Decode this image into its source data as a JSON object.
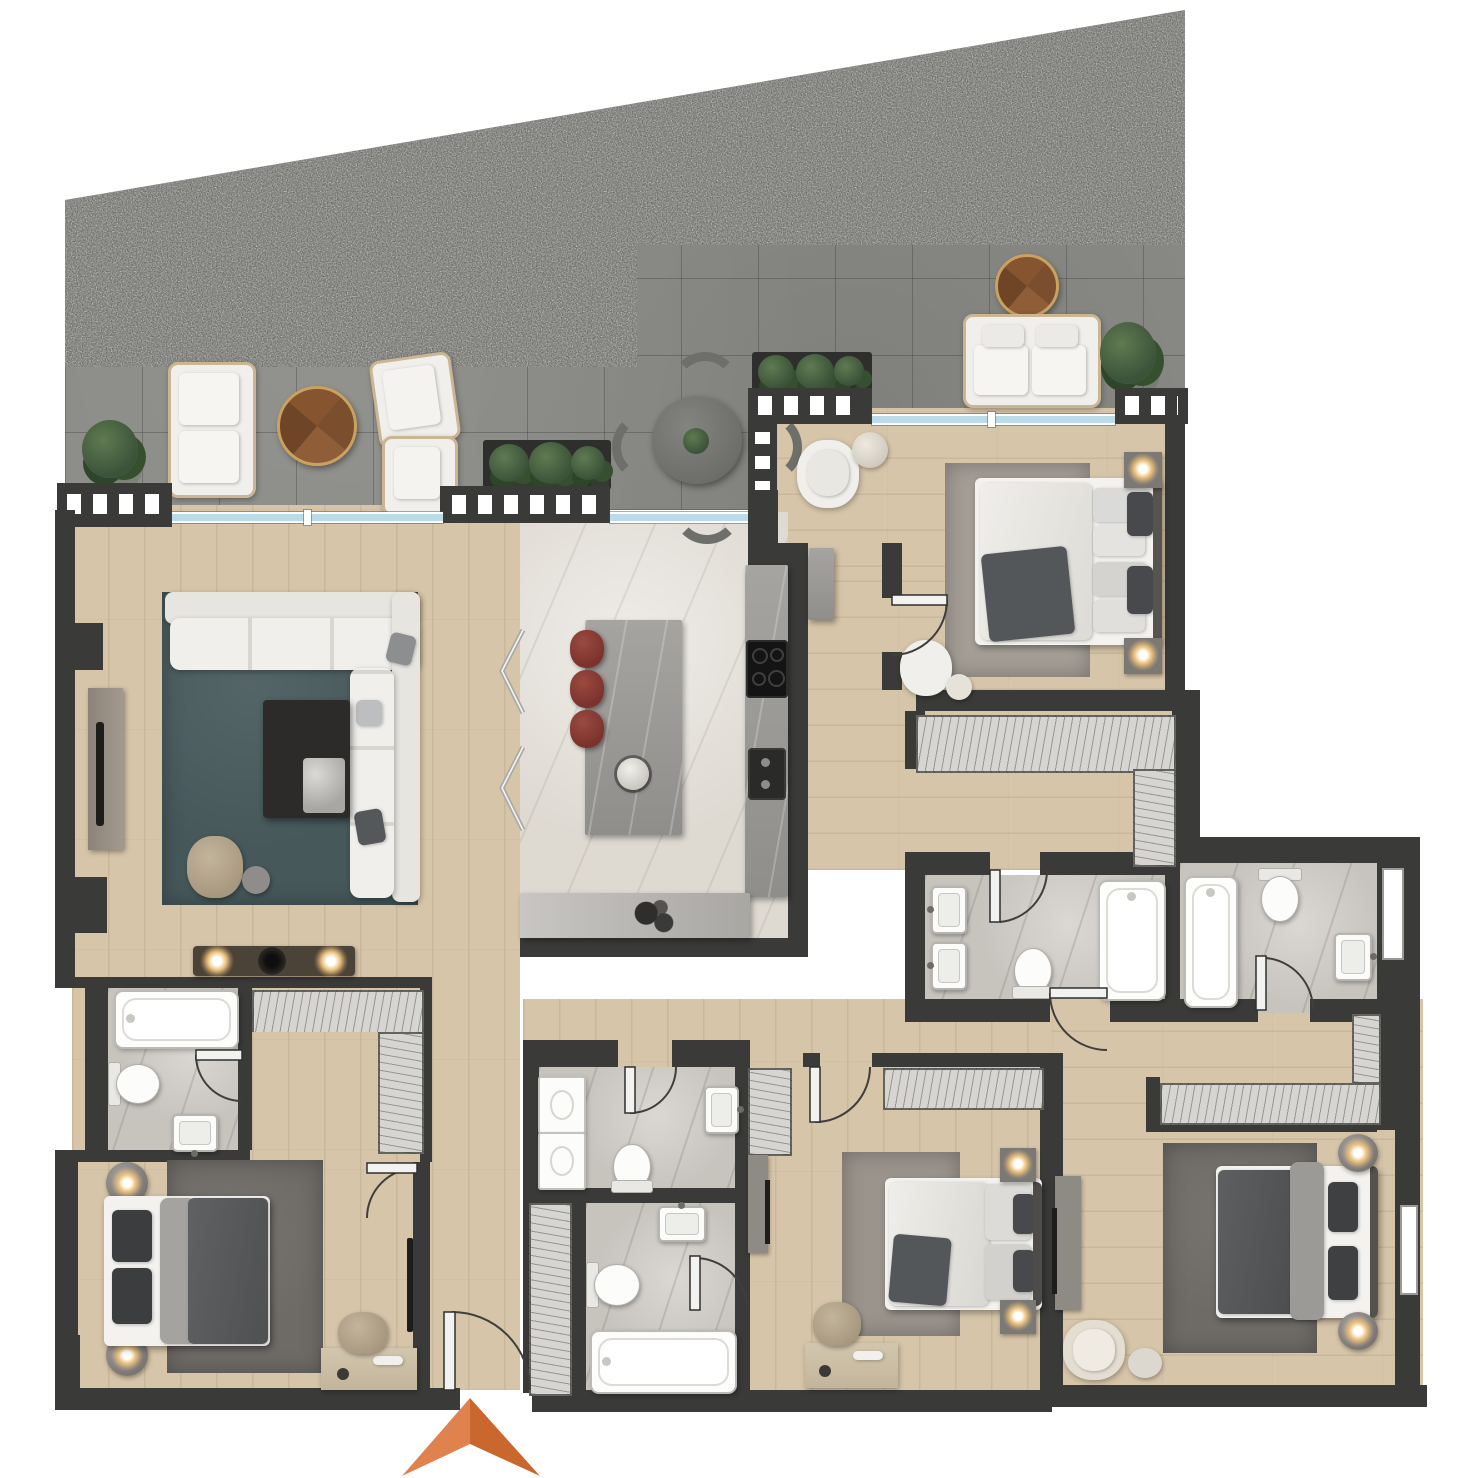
{
  "meta": {
    "scene": "apartment-floor-plan-render",
    "view": "top-down",
    "canvas": {
      "width": 1462,
      "height": 1478
    },
    "visible_text": "none"
  },
  "palette": {
    "white": "#ffffff",
    "wall": "#3a3a38",
    "wood": "#d6c5a9",
    "tile": "#8a8a86",
    "gravelBase": "#585855",
    "kitchenFloor": "#ded9d1",
    "bathFloor": "#c7c3bd",
    "closet": "#d7d5d1",
    "glass": "#badbe7",
    "sofa": "#f0efeb",
    "rugTeal": "#46585a",
    "rugGray": "#a49e96",
    "rugWarmGray": "#9a948c",
    "rugDark": "#6e6b67",
    "duvetDark": "#54575a",
    "mattress": "#f3f2ef",
    "stool": "#7c322c",
    "glow": "#ecc27c",
    "plant": "#3c5239",
    "arrowLight": "#e0824e",
    "arrowDark": "#c9672f",
    "consoleGray": "#8e8a84",
    "deskTan": "#ccbfa6"
  },
  "north_arrow": {
    "shape": "concave-triangle",
    "position": "bottom-center-at-entry",
    "colors": [
      "#e0824e",
      "#c9672f"
    ]
  },
  "terrace": {
    "name": "terrace",
    "surfaces": [
      "gravel-bed-sloped-top-edge",
      "stone-tile-deck"
    ],
    "boundary": [
      "parapet-with-white-balusters",
      "glazed-sliding-windows"
    ],
    "furniture": [
      "outdoor-loveseat",
      "round-wood-coffee-table",
      "lounge-chair",
      "lounge-chair",
      "planter-box",
      "planter-box",
      "outdoor-dining-table-4-chairs",
      "outdoor-sofa",
      "round-wood-side-table",
      "potted-plant",
      "potted-plant",
      "potted-plant"
    ]
  },
  "rooms": [
    {
      "id": "living-room",
      "floor": "wood",
      "furniture": [
        "l-shaped-sectional-sofa",
        "teal-area-rug",
        "dark-marble-coffee-table",
        "tan-lounge-chair",
        "round-side-table",
        "tv-console",
        "media-wall-with-three-ceiling-lights"
      ]
    },
    {
      "id": "kitchen",
      "floor": "light-marble",
      "furniture": [
        "marble-island",
        "red-bar-stool",
        "red-bar-stool",
        "red-bar-stool",
        "fruit-bowl",
        "tall-counter-with-cooktop-and-sink",
        "back-counter-with-appliances",
        "folding-glass-doors"
      ]
    },
    {
      "id": "hallway-entry",
      "floor": "wood",
      "furniture": [
        "entrance-door",
        "linen-closet",
        "console-cabinet"
      ]
    },
    {
      "id": "bedroom-top-right",
      "floor": "wood",
      "furniture": [
        "double-bed",
        "nightstand-lamp",
        "nightstand-lamp",
        "gray-rug",
        "lounge-chair",
        "round-side-table",
        "bedroom-chair",
        "walk-in-wardrobe"
      ]
    },
    {
      "id": "ensuite-top-right",
      "floor": "gray-marble",
      "fixtures": [
        "vanity-sink",
        "vanity-sink",
        "toilet",
        "bathtub"
      ]
    },
    {
      "id": "bathroom-right",
      "floor": "gray-marble",
      "fixtures": [
        "bathtub",
        "toilet",
        "washbasin",
        "window"
      ]
    },
    {
      "id": "guest-wc-laundry",
      "floor": "gray-marble",
      "fixtures": [
        "stacked-washer",
        "stacked-dryer",
        "toilet",
        "washbasin"
      ]
    },
    {
      "id": "family-bathroom",
      "floor": "gray-marble",
      "fixtures": [
        "washbasin",
        "toilet",
        "bathtub"
      ]
    },
    {
      "id": "bathroom-bottom-left",
      "floor": "gray-marble",
      "fixtures": [
        "bathtub",
        "toilet",
        "washbasin"
      ]
    },
    {
      "id": "walkthrough-closet-bottom-left",
      "floor": "wood",
      "furniture": [
        "wardrobe-hatch-run",
        "wardrobe-hatch-run"
      ]
    },
    {
      "id": "bedroom-bottom-left",
      "floor": "wood",
      "furniture": [
        "double-bed-dark-duvet",
        "round-nightstand-lamp",
        "round-nightstand-lamp",
        "dark-rug",
        "desk",
        "desk-chair",
        "wall-tv"
      ]
    },
    {
      "id": "bedroom-bottom-middle",
      "floor": "wood",
      "furniture": [
        "double-bed",
        "nightstand-lamp",
        "nightstand-lamp",
        "rug",
        "wardrobe",
        "closet-run",
        "tv-console",
        "desk",
        "desk-chair"
      ]
    },
    {
      "id": "bedroom-bottom-right",
      "floor": "wood",
      "furniture": [
        "double-bed-dark-duvet",
        "round-nightstand-lamp",
        "round-nightstand-lamp",
        "dark-rug",
        "dressing-vestibule-wardrobes",
        "tv-console",
        "lounge-chair",
        "pouf"
      ]
    }
  ],
  "door_count": 11,
  "window_count": 5
}
